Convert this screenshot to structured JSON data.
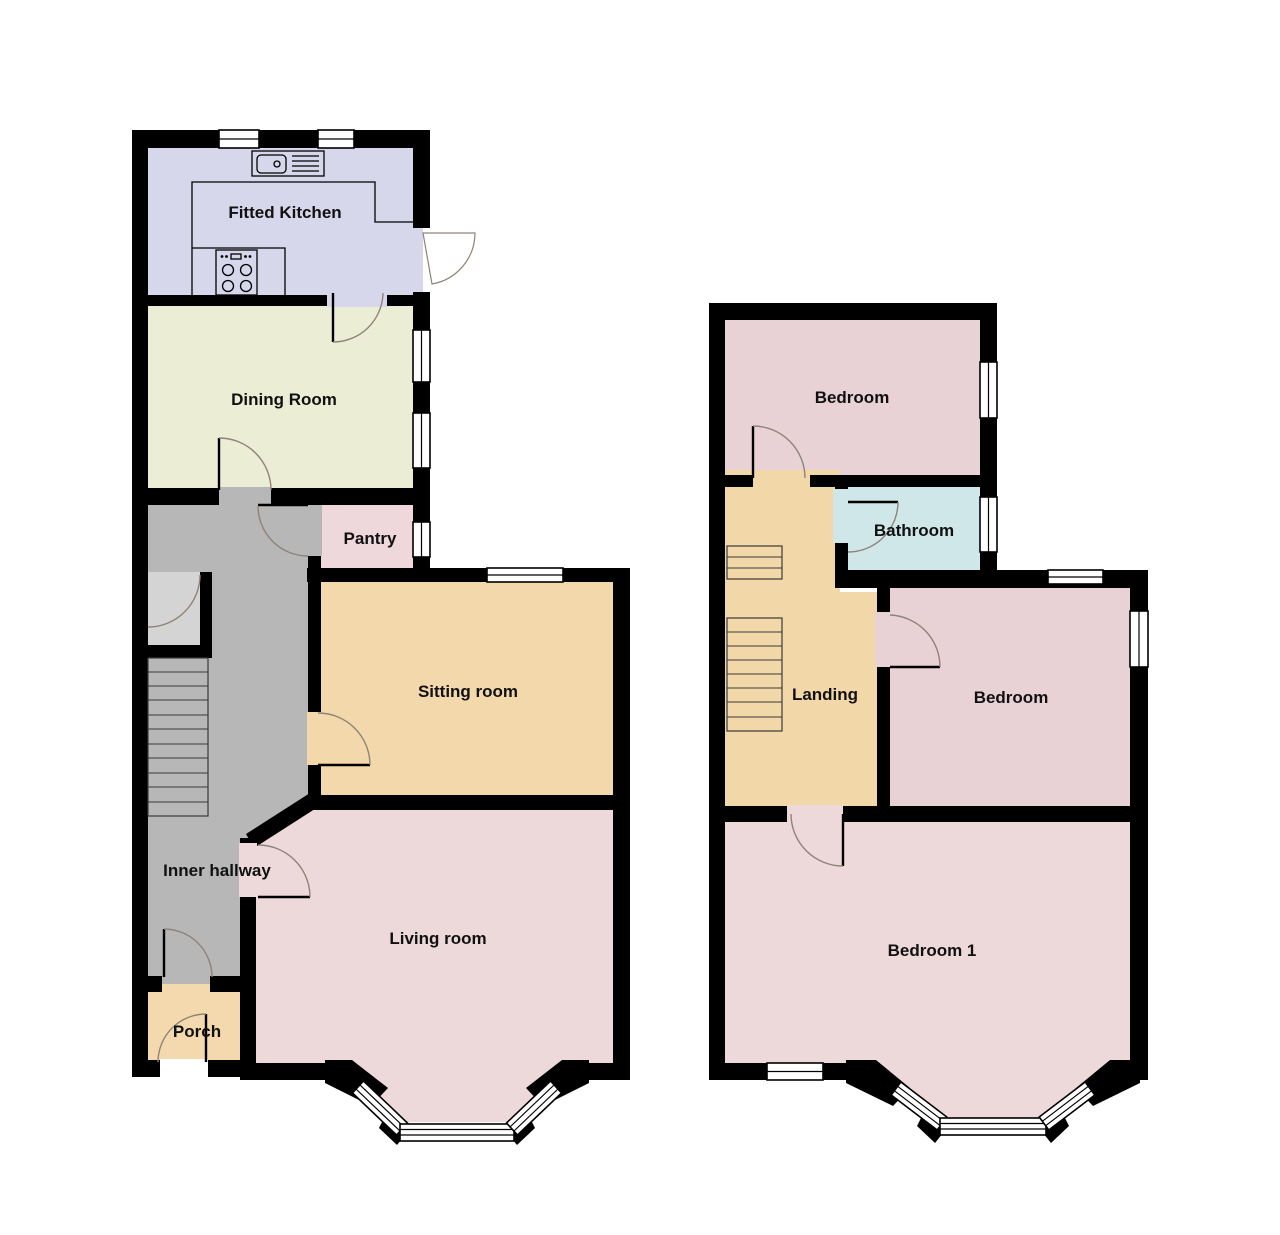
{
  "title": "House floor plan",
  "colors": {
    "background": "#ffffff",
    "wall": "#000000",
    "window_fill": "#ffffff",
    "arc": "#8f8379",
    "stair_outline": "#3a3a3a",
    "label": "#111111"
  },
  "ground_floor": {
    "name": "Ground floor",
    "rooms": {
      "kitchen": {
        "label": "Fitted Kitchen",
        "color": "#d7d7ec"
      },
      "dining": {
        "label": "Dining Room",
        "color": "#ebeed5"
      },
      "pantry": {
        "label": "Pantry",
        "color": "#efd8dc"
      },
      "sitting": {
        "label": "Sitting room",
        "color": "#f3d8ab"
      },
      "hallway": {
        "label": "Inner hallway",
        "color": "#b7b7b7"
      },
      "living": {
        "label": "Living room",
        "color": "#edd9da"
      },
      "porch": {
        "label": "Porch",
        "color": "#f3d9ad"
      },
      "closet": {
        "label": "",
        "color": "#d4d4d4"
      },
      "stairs": {
        "label": "",
        "color": "#bcbcbc"
      }
    }
  },
  "first_floor": {
    "name": "First floor",
    "rooms": {
      "bedroom_top": {
        "label": "Bedroom",
        "color": "#e9d2d6"
      },
      "bathroom": {
        "label": "Bathroom",
        "color": "#cfe7e9"
      },
      "landing": {
        "label": "Landing",
        "color": "#f2d7a8"
      },
      "bedroom_mid": {
        "label": "Bedroom",
        "color": "#e9d2d6"
      },
      "bedroom1": {
        "label": "Bedroom 1",
        "color": "#edd9da"
      }
    }
  }
}
